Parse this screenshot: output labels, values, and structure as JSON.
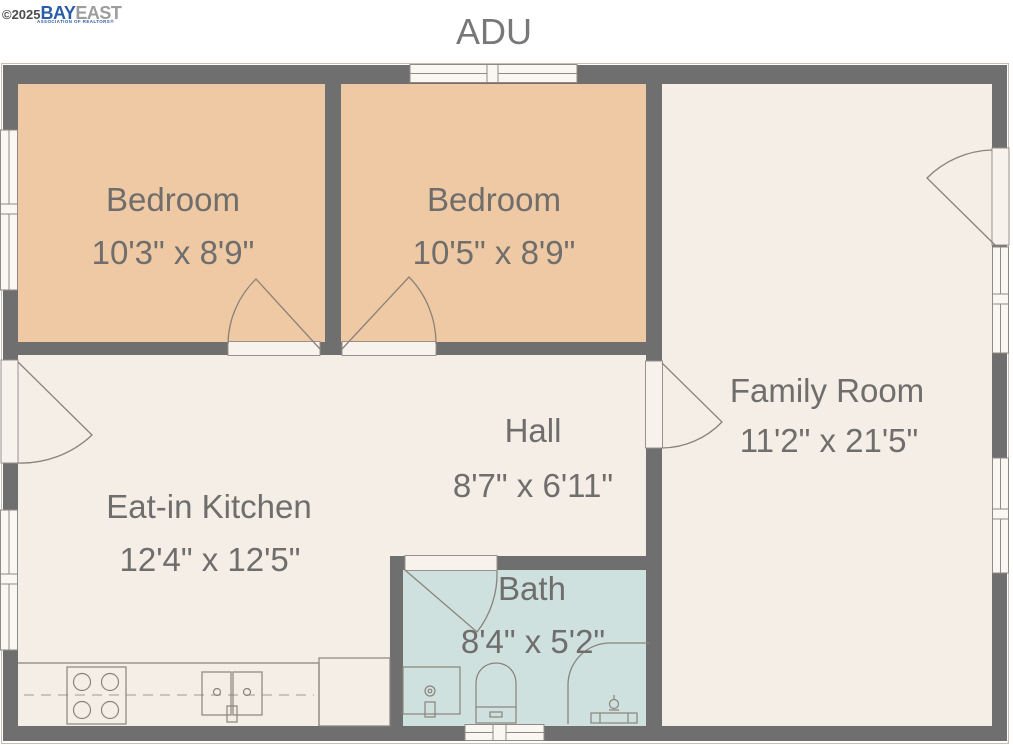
{
  "title": "ADU",
  "watermark": {
    "copyright": "©2025",
    "brand_primary": "BAY",
    "brand_secondary": "EAST",
    "brand_tagline": "ASSOCIATION OF REALTORS®"
  },
  "rooms": [
    {
      "id": "bedroom-1",
      "name": "Bedroom",
      "dimensions": "10'3\" x 8'9\""
    },
    {
      "id": "bedroom-2",
      "name": "Bedroom",
      "dimensions": "10'5\" x 8'9\""
    },
    {
      "id": "family-room",
      "name": "Family Room",
      "dimensions": "11'2\" x 21'5\""
    },
    {
      "id": "eat-in-kitchen",
      "name": "Eat-in Kitchen",
      "dimensions": "12'4\" x 12'5\""
    },
    {
      "id": "hall",
      "name": "Hall",
      "dimensions": "8'7\" x 6'11\""
    },
    {
      "id": "bath",
      "name": "Bath",
      "dimensions": "8'4\" x 5'2\""
    }
  ],
  "fixtures": [
    "stove",
    "kitchen-sink",
    "kitchen-counter",
    "shower",
    "toilet",
    "bathroom-sink"
  ],
  "openings": {
    "doors": 6,
    "windows": 6
  },
  "colors": {
    "wall": "#6f6f6f",
    "bedroom_fill": "#eec9a4",
    "living_fill": "#f5eee6",
    "bath_fill": "#cfe1de",
    "label_text": "#6f6e6d",
    "brand_blue": "#2a5ca8",
    "brand_gray": "#9d9d9d",
    "fixture_line": "#8a837b"
  }
}
